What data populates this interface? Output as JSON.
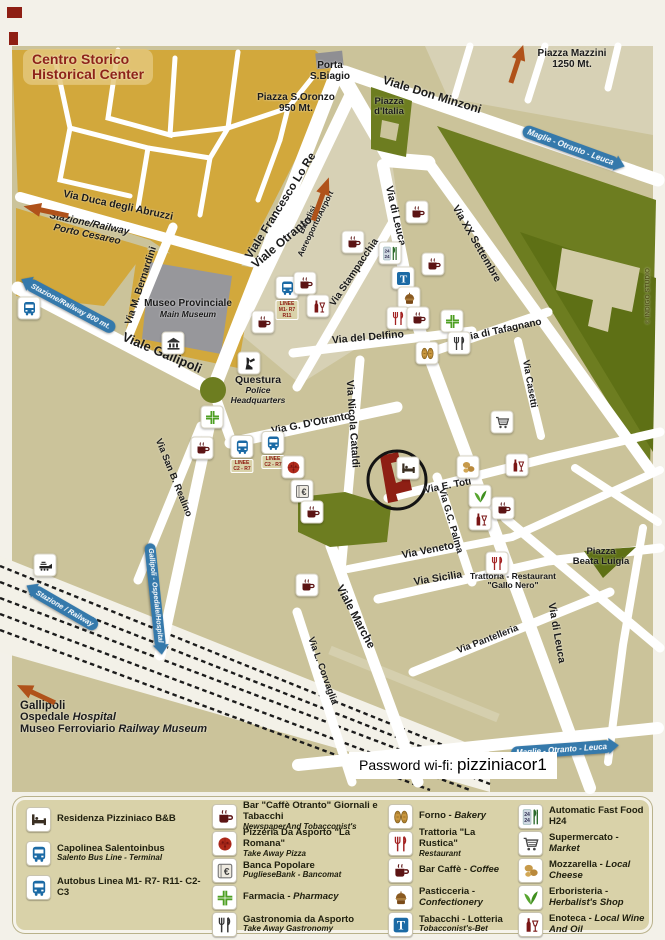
{
  "title": {
    "main": "MAPPA DEL VICINATO - ",
    "sub": "NEIGHBOURHOOD MAP"
  },
  "colors": {
    "maroon": "#8e1b12",
    "gold": "#d2a83c",
    "park_green": "#6d7d20",
    "block_khaki": "#cbc39a",
    "arrow_blue": "#3579ab",
    "arrow_brown": "#b0521a"
  },
  "map": {
    "wifi_label": "Password wi-fi: ",
    "wifi_password": "pizziniacor1",
    "labels": [
      {
        "n": "centro-storico",
        "x": 88,
        "y": 67,
        "bg": 1,
        "color": "#8e2318",
        "lines": [
          {
            "t": "Centro Storico",
            "fs": 14
          },
          {
            "t": "Historical Center",
            "fs": 14
          }
        ]
      },
      {
        "n": "porta-s-biagio",
        "x": 330,
        "y": 72,
        "lines": [
          {
            "t": "Porta",
            "fs": 10
          },
          {
            "t": "S.Biagio",
            "fs": 10
          }
        ]
      },
      {
        "n": "piazza-s-oronzo",
        "x": 296,
        "y": 104,
        "lines": [
          {
            "t": "Piazza S.Oronzo",
            "fs": 10
          },
          {
            "t": "950 Mt.",
            "fs": 10
          }
        ]
      },
      {
        "n": "piazza-mazzini",
        "x": 572,
        "y": 60,
        "lines": [
          {
            "t": "Piazza Mazzini",
            "fs": 10
          },
          {
            "t": "1250 Mt.",
            "fs": 10
          }
        ]
      },
      {
        "n": "viale-don-minzoni",
        "x": 432,
        "y": 95,
        "rot": 17,
        "lines": [
          {
            "t": "Viale Don Minzoni",
            "fs": 12
          }
        ]
      },
      {
        "n": "piazza-d-italia",
        "x": 389,
        "y": 107,
        "lines": [
          {
            "t": "Piazza",
            "fs": 9.5
          },
          {
            "t": "d'Italia",
            "fs": 9.5
          }
        ]
      },
      {
        "n": "via-xx-settembre",
        "x": 476,
        "y": 244,
        "rot": 60,
        "lines": [
          {
            "t": "Via XX  Settembre",
            "fs": 10.5
          }
        ]
      },
      {
        "n": "viale-francesco-lo-re",
        "x": 281,
        "y": 206,
        "rot": -58,
        "lines": [
          {
            "t": "Viale Francesco Lo Re",
            "fs": 11.5
          }
        ]
      },
      {
        "n": "brindisi-airport",
        "x": 312,
        "y": 222,
        "rot": -64,
        "lines": [
          {
            "t": "Brindisi",
            "fs": 8
          },
          {
            "t": "Aereoporto/Airport",
            "fs": 8
          }
        ]
      },
      {
        "n": "viale-otranto",
        "x": 282,
        "y": 242,
        "rot": -40,
        "lines": [
          {
            "t": "Viale Otranto",
            "fs": 12
          }
        ]
      },
      {
        "n": "via-stampacchia",
        "x": 355,
        "y": 273,
        "rot": -56,
        "lines": [
          {
            "t": "Via Stampacchia",
            "fs": 10
          }
        ]
      },
      {
        "n": "via-di-leuca-top",
        "x": 395,
        "y": 216,
        "rot": 77,
        "lines": [
          {
            "t": "Via di Leuca",
            "fs": 10.5
          }
        ]
      },
      {
        "n": "via-duca-degli-abruzzi",
        "x": 118,
        "y": 206,
        "rot": 12,
        "lines": [
          {
            "t": "Via Duca degli Abruzzi",
            "fs": 10.5
          }
        ]
      },
      {
        "n": "stazione-porto-cesareo",
        "x": 88,
        "y": 230,
        "rot": 12,
        "lines": [
          {
            "t": "Stazione/Railway",
            "fs": 10,
            "i": 1
          },
          {
            "t": "Porto Cesareo",
            "fs": 10,
            "i": 1
          }
        ]
      },
      {
        "n": "via-m-bernardini",
        "x": 142,
        "y": 286,
        "rot": -72,
        "lines": [
          {
            "t": "Via M. Bernardini",
            "fs": 10
          }
        ]
      },
      {
        "n": "museo-provinciale",
        "x": 188,
        "y": 309,
        "lines": [
          {
            "t": "Museo Provinciale",
            "fs": 10
          },
          {
            "ti": "Main Museum",
            "fs": 8.5
          }
        ]
      },
      {
        "n": "viale-gallipoli",
        "x": 162,
        "y": 353,
        "rot": 23,
        "lines": [
          {
            "t": "Viale  Gallipoli",
            "fs": 13
          }
        ]
      },
      {
        "n": "questura",
        "x": 258,
        "y": 390,
        "lines": [
          {
            "t": "Questura",
            "fs": 10.5
          },
          {
            "ti": "Police",
            "fs": 8.5
          },
          {
            "ti": "Headquarters",
            "fs": 8.5
          }
        ]
      },
      {
        "n": "via-g-dotranto",
        "x": 311,
        "y": 424,
        "rot": -11,
        "lines": [
          {
            "t": "Via G. D'Otranto",
            "fs": 10.5
          }
        ]
      },
      {
        "n": "via-nicola-cataldi",
        "x": 352,
        "y": 424,
        "rot": 86,
        "lines": [
          {
            "t": "Via Nicola Cataldi",
            "fs": 10.5
          }
        ]
      },
      {
        "n": "via-del-delfino",
        "x": 368,
        "y": 338,
        "rot": -5,
        "lines": [
          {
            "t": "Via del Delfino",
            "fs": 10.5
          }
        ]
      },
      {
        "n": "via-di-tafagnano",
        "x": 503,
        "y": 331,
        "rot": -12,
        "lines": [
          {
            "t": "Via di Tafagnano",
            "fs": 10
          }
        ]
      },
      {
        "n": "via-casetti",
        "x": 529,
        "y": 384,
        "rot": 80,
        "lines": [
          {
            "t": "Via Casetti",
            "fs": 9.5
          }
        ]
      },
      {
        "n": "via-e-toti",
        "x": 448,
        "y": 487,
        "rot": -11,
        "lines": [
          {
            "t": "Via E. Toti",
            "fs": 10
          }
        ]
      },
      {
        "n": "via-gc-palma",
        "x": 450,
        "y": 521,
        "rot": 74,
        "lines": [
          {
            "t": "Via G.C. Palma",
            "fs": 9.5
          }
        ]
      },
      {
        "n": "via-veneto",
        "x": 428,
        "y": 551,
        "rot": -11,
        "lines": [
          {
            "t": "Via Veneto",
            "fs": 10.5
          }
        ]
      },
      {
        "n": "via-sicilia",
        "x": 438,
        "y": 579,
        "rot": -9,
        "lines": [
          {
            "t": "Via Sicilia",
            "fs": 10.5
          }
        ]
      },
      {
        "n": "trattoria-gallo-nero",
        "x": 513,
        "y": 581,
        "lines": [
          {
            "t": "Trattoria - Restaurant",
            "fs": 8.5
          },
          {
            "t": "\"Gallo Nero\"",
            "fs": 8.5
          }
        ]
      },
      {
        "n": "piazza-beata-luigia",
        "x": 601,
        "y": 557,
        "lines": [
          {
            "t": "Piazza",
            "fs": 9.5
          },
          {
            "t": "Beata Luigia",
            "fs": 9.5
          }
        ]
      },
      {
        "n": "viale-marche",
        "x": 355,
        "y": 617,
        "rot": 62,
        "lines": [
          {
            "t": "Viale  Marche",
            "fs": 11.5
          }
        ]
      },
      {
        "n": "via-l-corvaglia",
        "x": 322,
        "y": 671,
        "rot": 70,
        "lines": [
          {
            "t": "Via L. Corvaglia",
            "fs": 9.5
          }
        ]
      },
      {
        "n": "via-pantelleria",
        "x": 488,
        "y": 640,
        "rot": -21,
        "lines": [
          {
            "t": "Via Pantelleria",
            "fs": 9.5
          }
        ]
      },
      {
        "n": "via-di-leuca-bottom",
        "x": 556,
        "y": 633,
        "rot": 80,
        "lines": [
          {
            "t": "Via di Leuca",
            "fs": 10.5
          }
        ]
      },
      {
        "n": "via-san-b-realino",
        "x": 173,
        "y": 478,
        "rot": 68,
        "lines": [
          {
            "t": "Via San B. Realino",
            "fs": 9.5
          }
        ]
      },
      {
        "n": "gallipoli-info",
        "x": 20,
        "y": 700,
        "align": "l",
        "lines": [
          {
            "t": "Gallipoli",
            "fs": 11.5
          },
          {
            "t": "Ospedale ",
            "ti": "Hospital",
            "fs": 11
          },
          {
            "t": "Museo Ferroviario ",
            "ti": "Railway Museum",
            "fs": 11
          }
        ]
      },
      {
        "n": "indigo-credit",
        "x": 648,
        "y": 296,
        "rot": -90,
        "color": "#55551c",
        "lines": [
          {
            "t": "© INDIGO STUDIO",
            "fs": 6.5
          }
        ]
      }
    ],
    "arrows_blue": [
      {
        "n": "arrow-maglie-otranto-leuca-top",
        "x": 574,
        "y": 148,
        "rot": 20,
        "head": "r",
        "text": "Maglie - Otranto - Leuca",
        "fs": 8
      },
      {
        "n": "arrow-stazione-railway-800",
        "x": 68,
        "y": 304,
        "rot": 28,
        "head": "l",
        "text": "Stazione/Railway 800 mt.",
        "fs": 7.5
      },
      {
        "n": "arrow-gallipoli-ospedale",
        "x": 156,
        "y": 599,
        "rot": 84,
        "head": "r",
        "text": "Gallipoli - Ospedale/Hospital",
        "fs": 7
      },
      {
        "n": "arrow-stazione-railway",
        "x": 62,
        "y": 606,
        "rot": 30,
        "head": "l",
        "text": "Stazione / Railway",
        "fs": 7.5
      },
      {
        "n": "arrow-maglie-otranto-leuca-bottom",
        "x": 565,
        "y": 749,
        "rot": -4,
        "head": "r",
        "text": "Maglie - Otranto - Leuca",
        "fs": 8
      }
    ],
    "arrows_brown": [
      {
        "n": "arrow-porto-cesareo",
        "x": 46,
        "y": 211,
        "rot": 12,
        "len": 46,
        "head": "l"
      },
      {
        "n": "arrow-piazza-mazzini",
        "x": 517,
        "y": 64,
        "rot": -72,
        "len": 40,
        "head": "r"
      },
      {
        "n": "arrow-brindisi-airport",
        "x": 321,
        "y": 199,
        "rot": -70,
        "len": 46,
        "head": "r"
      },
      {
        "n": "arrow-gallipoli-museum",
        "x": 36,
        "y": 694,
        "rot": 25,
        "len": 42,
        "head": "l"
      }
    ],
    "icons": [
      {
        "t": "bus",
        "x": 287,
        "y": 298,
        "tag": [
          "LINEE",
          "M1- R7",
          "R11"
        ]
      },
      {
        "t": "coffee",
        "x": 353,
        "y": 242
      },
      {
        "t": "coffee",
        "x": 417,
        "y": 212
      },
      {
        "t": "coffee",
        "x": 433,
        "y": 264
      },
      {
        "t": "fastfood24",
        "x": 390,
        "y": 253
      },
      {
        "t": "tabacchi",
        "x": 403,
        "y": 278
      },
      {
        "t": "pastry",
        "x": 409,
        "y": 298
      },
      {
        "t": "trattoria",
        "x": 398,
        "y": 318
      },
      {
        "t": "coffee",
        "x": 418,
        "y": 318
      },
      {
        "t": "pharmacy",
        "x": 452,
        "y": 321
      },
      {
        "t": "bakery",
        "x": 427,
        "y": 353
      },
      {
        "t": "gastronomia",
        "x": 459,
        "y": 343
      },
      {
        "t": "coffee",
        "x": 305,
        "y": 283
      },
      {
        "t": "bar_wine",
        "x": 318,
        "y": 306
      },
      {
        "t": "coffee",
        "x": 263,
        "y": 322
      },
      {
        "t": "police",
        "x": 249,
        "y": 363
      },
      {
        "t": "museum",
        "x": 173,
        "y": 343
      },
      {
        "t": "bus",
        "x": 29,
        "y": 308
      },
      {
        "t": "pharmacy",
        "x": 212,
        "y": 417
      },
      {
        "t": "coffee",
        "x": 202,
        "y": 448
      },
      {
        "t": "bus",
        "x": 242,
        "y": 454,
        "tag": [
          "LINEE",
          "C2 - R7"
        ]
      },
      {
        "t": "bus",
        "x": 273,
        "y": 450,
        "tag": [
          "LINEE",
          "C2 - R7"
        ]
      },
      {
        "t": "pizza",
        "x": 293,
        "y": 467
      },
      {
        "t": "bank",
        "x": 302,
        "y": 491
      },
      {
        "t": "coffee",
        "x": 312,
        "y": 512
      },
      {
        "t": "bed",
        "x": 408,
        "y": 468
      },
      {
        "t": "cart",
        "x": 502,
        "y": 422
      },
      {
        "t": "enoteca",
        "x": 517,
        "y": 465
      },
      {
        "t": "mozzarella",
        "x": 468,
        "y": 467
      },
      {
        "t": "herbs",
        "x": 480,
        "y": 496
      },
      {
        "t": "coffee",
        "x": 503,
        "y": 508
      },
      {
        "t": "bar_wine",
        "x": 480,
        "y": 519
      },
      {
        "t": "coffee",
        "x": 307,
        "y": 585
      },
      {
        "t": "trattoria",
        "x": 497,
        "y": 563
      },
      {
        "t": "train",
        "x": 45,
        "y": 565
      }
    ]
  },
  "legend": {
    "columns": [
      {
        "items": [
          {
            "icon": "bed",
            "t": "Residenza Pizziniaco B&B"
          },
          {
            "icon": "bus",
            "t": "Capolinea Salentoinbus",
            "s": "Salento Bus Line - Terminal"
          },
          {
            "icon": "bus",
            "t": "Autobus Linea M1- R7- R11- C2- C3"
          }
        ]
      },
      {
        "items": [
          {
            "icon": "coffee",
            "t": "Bar \"Caffè Otranto\" Giornali e Tabacchi",
            "s": "NewspaperAnd Tobacconist's"
          },
          {
            "icon": "pizza",
            "t": "Pizzeria Da Asporto \"La Romana\"",
            "s": "Take Away Pizza"
          },
          {
            "icon": "bank",
            "t": "Banca Popolare",
            "s": "PuglieseBank - Bancomat"
          },
          {
            "icon": "pharmacy",
            "t": "Farmacia - ",
            "e": "Pharmacy"
          },
          {
            "icon": "gastronomia",
            "t": "Gastronomia da Asporto",
            "s": "Take Away Gastronomy"
          }
        ]
      },
      {
        "items": [
          {
            "icon": "bakery",
            "t": "Forno - ",
            "e": "Bakery"
          },
          {
            "icon": "trattoria",
            "t": "Trattoria \"La Rustica\"",
            "s": "Restaurant"
          },
          {
            "icon": "coffee",
            "t": "Bar Caffè - ",
            "e": "Coffee"
          },
          {
            "icon": "pastry",
            "t": "Pasticceria - ",
            "e": "Confectionery"
          },
          {
            "icon": "tabacchi",
            "t": "Tabacchi - Lotteria",
            "s": "Tobacconist's-Bet"
          }
        ]
      },
      {
        "items": [
          {
            "icon": "fastfood24",
            "t": "Automatic Fast Food  H24"
          },
          {
            "icon": "cart",
            "t": "Supermercato - ",
            "e": "Market"
          },
          {
            "icon": "mozzarella",
            "t": "Mozzarella - ",
            "e": "Local Cheese"
          },
          {
            "icon": "herbs",
            "t": "Erboristeria - ",
            "e": "Herbalist's Shop"
          },
          {
            "icon": "enoteca",
            "t": "Enoteca - ",
            "e": "Local Wine And Oil"
          }
        ]
      }
    ]
  }
}
